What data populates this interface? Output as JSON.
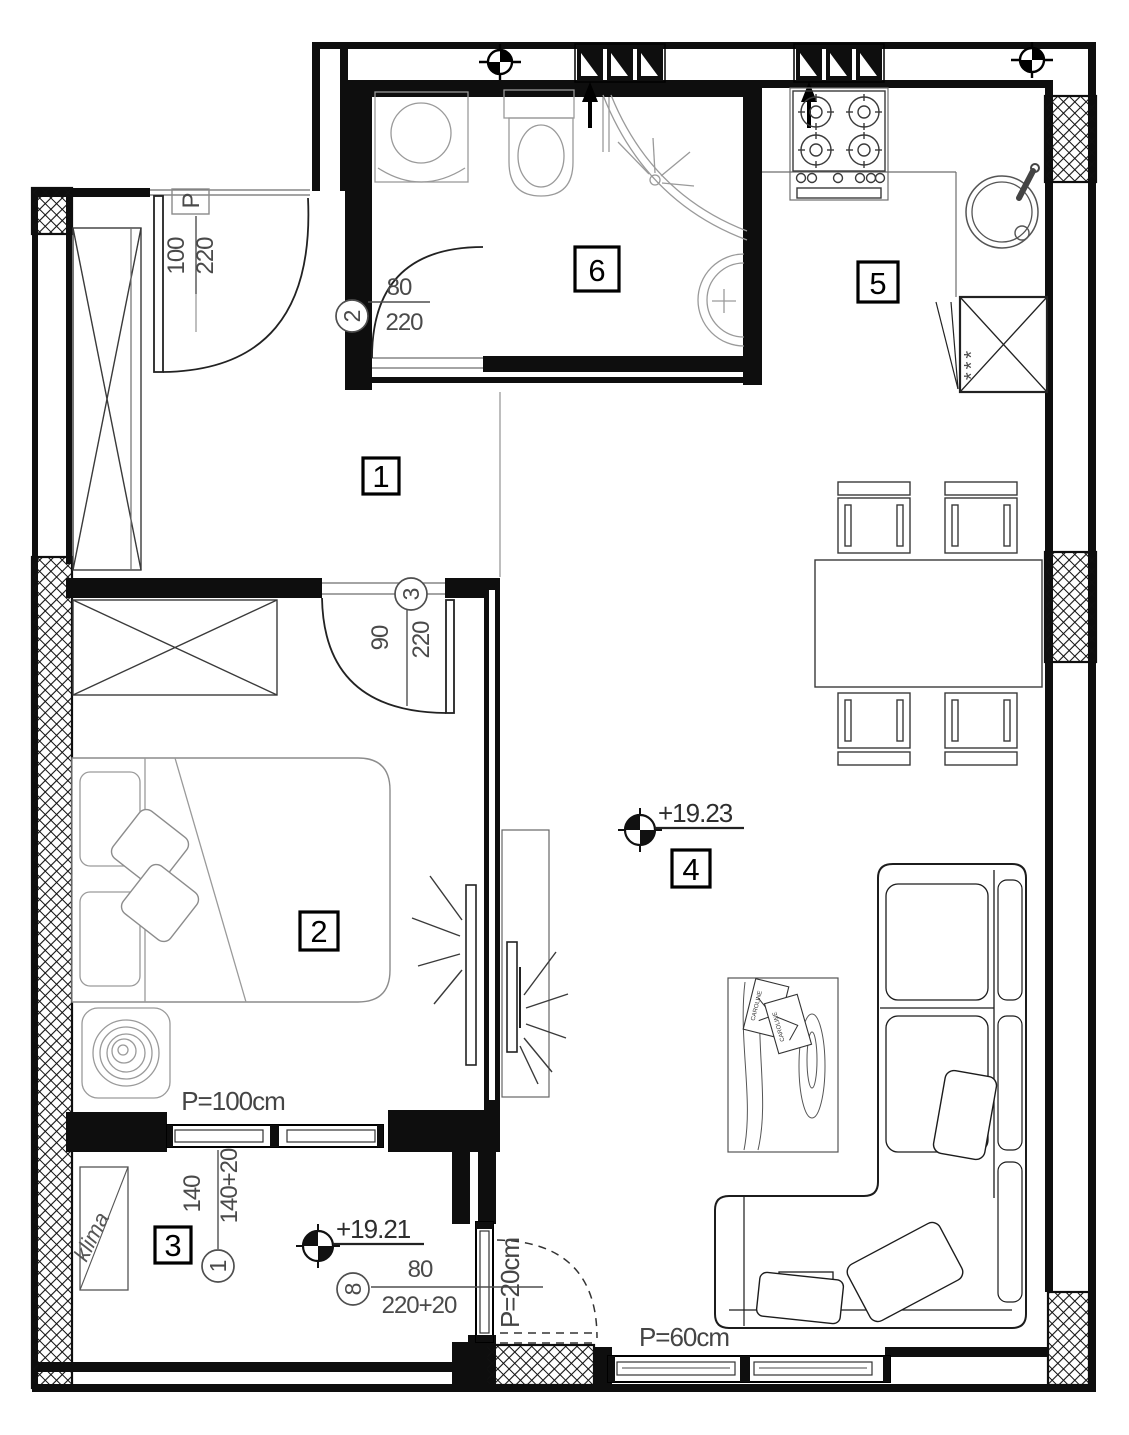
{
  "rooms": {
    "hall": "1",
    "bedroom": "2",
    "loggia": "3",
    "living": "4",
    "kitchen": "5",
    "bathroom": "6"
  },
  "elevations": {
    "living": "+19.23",
    "loggia": "+19.21"
  },
  "openings": {
    "entrance": {
      "label": "P",
      "width": "100",
      "height": "220"
    },
    "bathroom_door": {
      "tag": "2",
      "width": "80",
      "height": "220"
    },
    "bedroom_door": {
      "tag": "3",
      "width": "90",
      "height": "220"
    },
    "loggia_window": {
      "tag": "1",
      "width": "140",
      "height": "140+20",
      "parapet": "P=100cm"
    },
    "loggia_door": {
      "tag": "8",
      "width": "80",
      "height": "220+20",
      "parapet": "P=20cm"
    },
    "living_window": {
      "parapet": "P=60cm"
    }
  },
  "labels": {
    "klima": "klima",
    "fridge_frost": "***",
    "magazine": "CAROLINE"
  }
}
